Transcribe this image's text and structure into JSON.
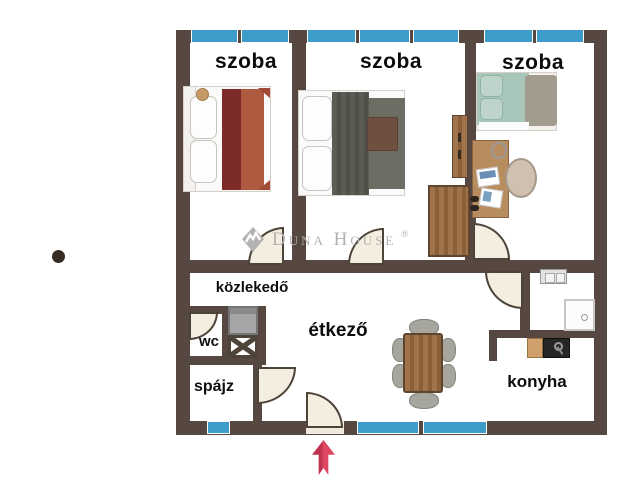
{
  "rooms": {
    "room1": {
      "label": "szoba"
    },
    "room2": {
      "label": "szoba"
    },
    "room3": {
      "label": "szoba"
    },
    "hallway": {
      "label": "közlekedő"
    },
    "wc": {
      "label": "wc"
    },
    "pantry": {
      "label": "spájz"
    },
    "dining": {
      "label": "étkező"
    },
    "kitchen": {
      "label": "konyha"
    }
  },
  "watermark": {
    "brand": "Duna House",
    "registered_mark": "®"
  },
  "colors": {
    "wall": "#564840",
    "window_glass": "#3e9ccb",
    "door_fill": "#f4eee1",
    "entrance_arrow": "#d23b55",
    "watermark": "#b4b2b1"
  },
  "icons": {
    "entrance_arrow": "up-arrow",
    "shaft": "x-cross-shaft",
    "dot_marker": "dot"
  }
}
